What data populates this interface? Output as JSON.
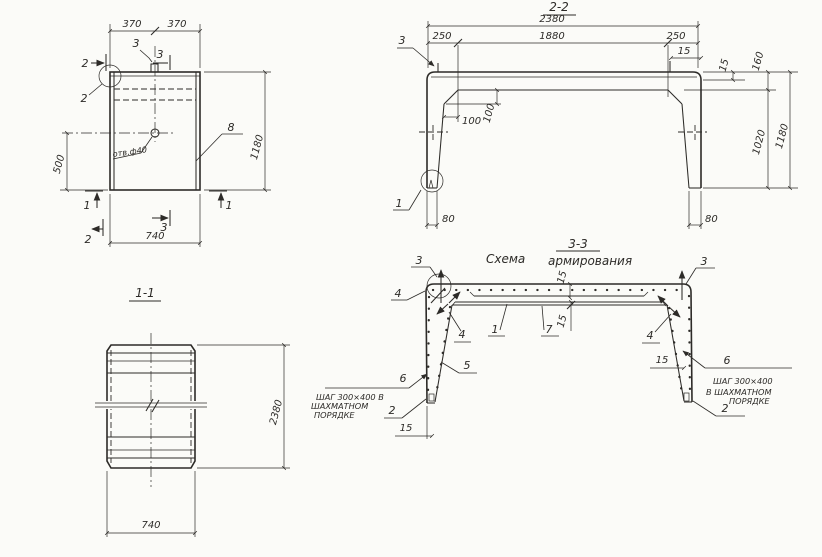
{
  "meta": {
    "background": "#fbfbf8",
    "ink": "#2d2b28",
    "drawing_type": "reinforced concrete element working drawing"
  },
  "plan": {
    "dim_370_l": "370",
    "dim_370_r": "370",
    "dim_1180": "1180",
    "dim_500": "500",
    "dim_740": "740",
    "hole_note": "отв.ф40",
    "label_8": "8",
    "m2_top": "2",
    "m2_corner": "2",
    "m3_top": "3",
    "m3_flag": "3",
    "m1_left": "1",
    "m1_right": "1",
    "m3_bottom": "3",
    "m2_bottom": "2"
  },
  "s11": {
    "title": "1-1",
    "dim_740": "740",
    "dim_2380": "2380"
  },
  "s22": {
    "title": "2-2",
    "dim_2380": "2380",
    "dim_1880": "1880",
    "dim_250_l": "250",
    "dim_250_r": "250",
    "dim_15_top": "15",
    "dim_15_r": "15",
    "dim_160": "160",
    "dim_1020": "1020",
    "dim_1180": "1180",
    "dim_100_h": "100",
    "dim_100_v": "100",
    "dim_80_l": "80",
    "dim_80_r": "80",
    "label_3": "3",
    "label_1": "1"
  },
  "s33": {
    "title_prefix": "Схема",
    "title_num": "3-3",
    "title_suffix": "армирования",
    "dim_15_top": "15",
    "dim_15_mid": "15",
    "dim_15_r": "15",
    "dim_15_b": "15",
    "l3l": "3",
    "l3r": "3",
    "l4tl": "4",
    "l4l": "4",
    "l4r": "4",
    "l1": "1",
    "l7": "7",
    "l5": "5",
    "l6l": "6",
    "l6r": "6",
    "l2l": "2",
    "l2r": "2",
    "note_left": [
      "ШАГ 300×400 В",
      "ШАХМАТНОМ",
      "ПОРЯДКЕ"
    ],
    "note_right": [
      "ШАГ 300×400",
      "В ШАХМАТНОМ",
      "ПОРЯДКЕ"
    ]
  }
}
